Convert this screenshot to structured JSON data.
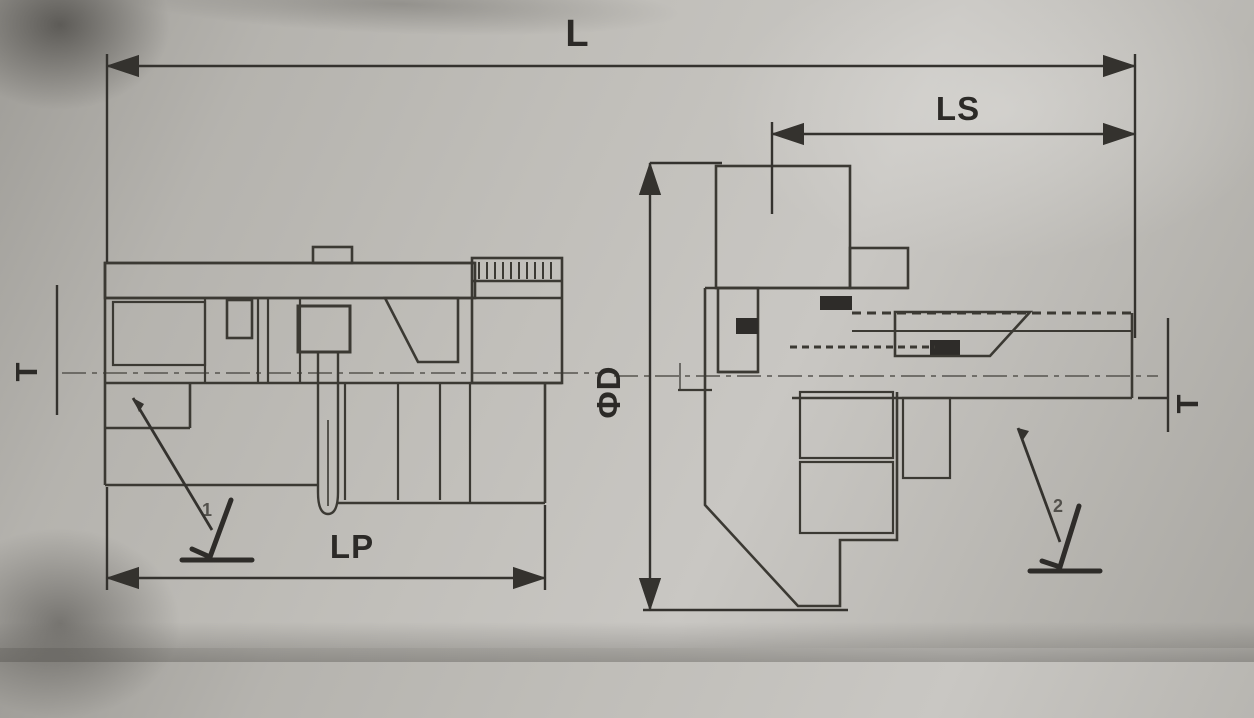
{
  "drawing": {
    "dimensions": {
      "overall_length": {
        "label": "L"
      },
      "socket_length": {
        "label": "LS"
      },
      "plug_length": {
        "label": "LP"
      },
      "diameter": {
        "label": "ΦD"
      },
      "thread_left": {
        "label": "T"
      },
      "thread_right": {
        "label": "T"
      }
    },
    "callouts": [
      {
        "number": "1"
      },
      {
        "number": "2"
      }
    ],
    "colors": {
      "line": "#3b3933",
      "seal": "#2e2c29",
      "paper": "#b9b7b2"
    }
  }
}
